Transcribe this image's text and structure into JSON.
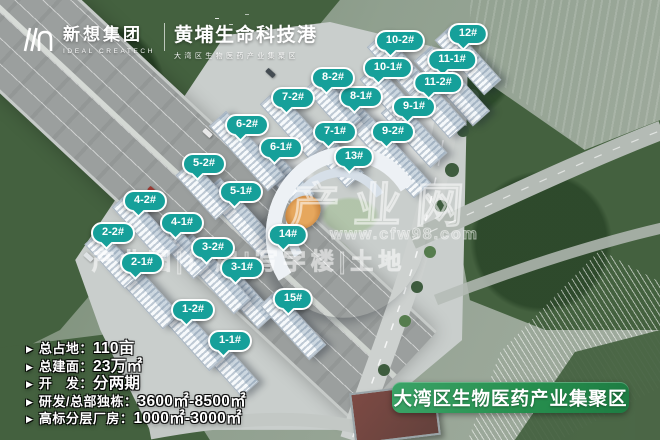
{
  "header": {
    "company_name": "新想集团",
    "company_name_en": "IDEAL CREATECH",
    "project_title": "黄埔生命科技港",
    "project_subtitle": "大湾区生物医药产业集聚区"
  },
  "building_labels": [
    {
      "text": "1-1#",
      "x": 230,
      "y": 341
    },
    {
      "text": "1-2#",
      "x": 193,
      "y": 310
    },
    {
      "text": "2-1#",
      "x": 142,
      "y": 263
    },
    {
      "text": "2-2#",
      "x": 113,
      "y": 233
    },
    {
      "text": "3-1#",
      "x": 242,
      "y": 268
    },
    {
      "text": "3-2#",
      "x": 213,
      "y": 248
    },
    {
      "text": "4-1#",
      "x": 182,
      "y": 223
    },
    {
      "text": "4-2#",
      "x": 145,
      "y": 201
    },
    {
      "text": "5-1#",
      "x": 241,
      "y": 192
    },
    {
      "text": "5-2#",
      "x": 204,
      "y": 164
    },
    {
      "text": "6-1#",
      "x": 281,
      "y": 148
    },
    {
      "text": "6-2#",
      "x": 247,
      "y": 125
    },
    {
      "text": "7-1#",
      "x": 335,
      "y": 132
    },
    {
      "text": "7-2#",
      "x": 293,
      "y": 98
    },
    {
      "text": "8-1#",
      "x": 361,
      "y": 97
    },
    {
      "text": "8-2#",
      "x": 333,
      "y": 78
    },
    {
      "text": "9-1#",
      "x": 414,
      "y": 107
    },
    {
      "text": "9-2#",
      "x": 393,
      "y": 132
    },
    {
      "text": "10-1#",
      "x": 388,
      "y": 68
    },
    {
      "text": "10-2#",
      "x": 400,
      "y": 41
    },
    {
      "text": "11-1#",
      "x": 452,
      "y": 60
    },
    {
      "text": "11-2#",
      "x": 438,
      "y": 83
    },
    {
      "text": "12#",
      "x": 468,
      "y": 34
    },
    {
      "text": "13#",
      "x": 354,
      "y": 157
    },
    {
      "text": "14#",
      "x": 288,
      "y": 235
    },
    {
      "text": "15#",
      "x": 293,
      "y": 299
    }
  ],
  "stats": {
    "bullet": "▶",
    "items": [
      {
        "label": "总占地：",
        "value": "110亩"
      },
      {
        "label": "总建面：",
        "value": "23万㎡"
      },
      {
        "label": "开　发：",
        "value": "分两期"
      },
      {
        "label": "研发/总部独栋：",
        "value": "3600㎡-8500㎡"
      },
      {
        "label": "高标分层厂房：",
        "value": "1000㎡-3000㎡"
      }
    ]
  },
  "banner": {
    "text": "大湾区生物医药产业集聚区"
  },
  "watermark": {
    "title": "产业网",
    "url": "www.cfw98.com",
    "line": "产业园|厂房|写字楼|土地"
  },
  "colors": {
    "label_teal": "#16a09a",
    "banner_green": "#27904f"
  }
}
